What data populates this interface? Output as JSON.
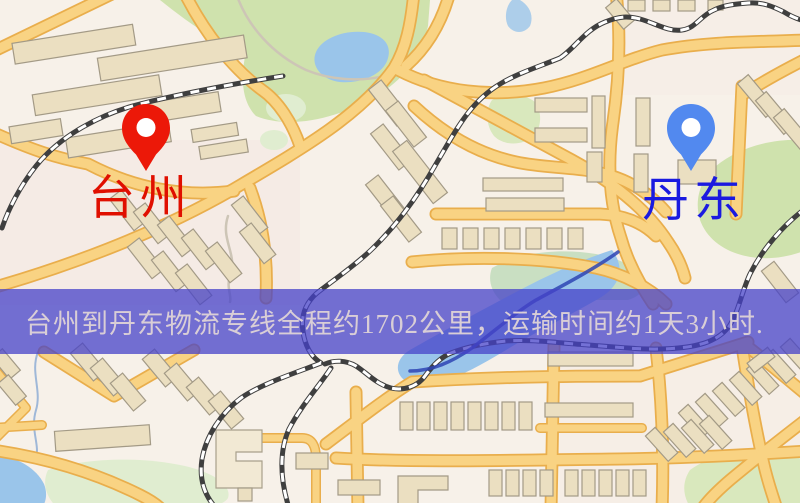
{
  "page": {
    "type": "logistics-route-map-image",
    "width_px": 800,
    "height_px": 503
  },
  "map": {
    "origin_marker": {
      "label": "台州",
      "pin_color": "#ec1808",
      "label_color": "#e00f00"
    },
    "destination_marker": {
      "label": "丹东",
      "pin_color": "#5289ef",
      "label_color": "#1a1ae0"
    },
    "banner": {
      "text": "台州到丹东物流专线全程约1702公里，运输时间约1天3小时.",
      "distance_text": "约1702公里",
      "duration_text": "约1天3小时",
      "background_color": "rgba(70,66,200,0.75)",
      "text_color": "#d9ced6"
    },
    "palette": {
      "background": "#f7f1e9",
      "road_fill": "#f9d383",
      "road_casing": "#e9ae4c",
      "park_green": "#cfe2ad",
      "pale_green": "#e0edd0",
      "water_blue": "#9ac5ea",
      "river_blue": "#2e44b4",
      "building_fill": "#ebdfc1",
      "building_outline": "#a39a86",
      "railway_dark": "#3f3f3f"
    }
  }
}
